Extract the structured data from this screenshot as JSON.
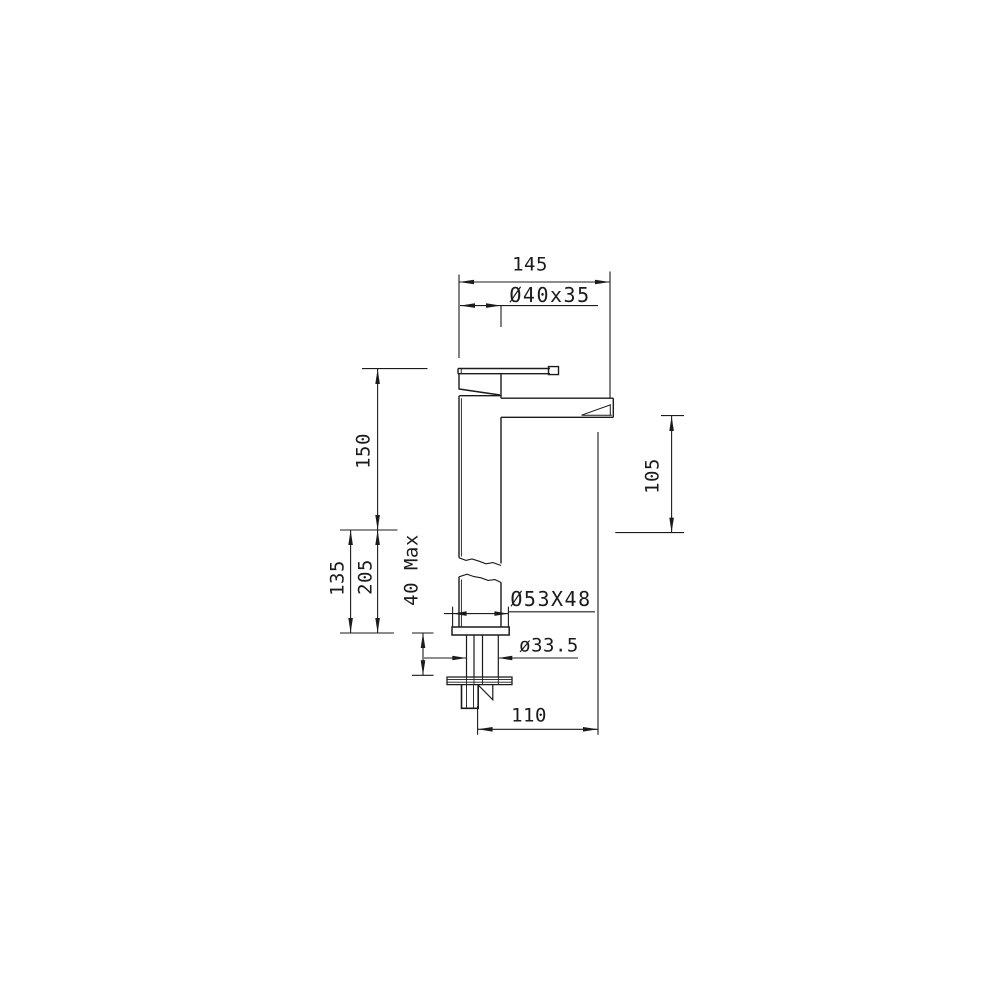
{
  "drawing": {
    "background": "#ffffff",
    "line_color": "#1b1b1b",
    "subject": "single-lever basin mixer faucet, side elevation technical drawing",
    "dimensions": {
      "overall_depth_top": "145",
      "handle_block": "Ø40x35",
      "upper_body_height": "150",
      "mid_height": "135",
      "total_mid_height": "205",
      "spout_outlet_height": "105",
      "deck_thickness_max": "40 Max",
      "base_footprint": "Ø53X48",
      "shank_diameter": "ø33.5",
      "spout_reach": "110"
    }
  }
}
